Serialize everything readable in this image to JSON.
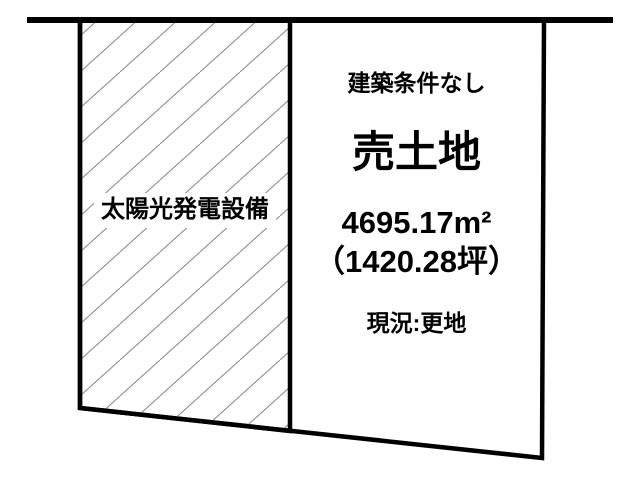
{
  "diagram": {
    "left_section": {
      "label": "太陽光発電設備"
    },
    "right_section": {
      "condition": "建築条件なし",
      "title": "売土地",
      "area_sqm": "4695.17m²",
      "area_tsubo": "（1420.28坪）",
      "status": "現況:更地"
    },
    "colors": {
      "line": "#000000",
      "hatch": "#8f8f8f",
      "background": "#ffffff",
      "text": "#000000"
    }
  }
}
